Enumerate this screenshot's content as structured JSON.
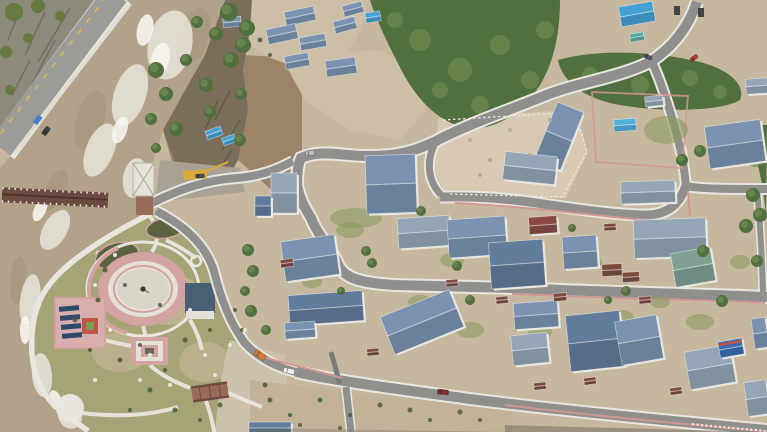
{
  "meta": {
    "description": "Aerial drone photograph: a Tibetan-style riverside village of blue-roofed houses with winding fenced roads, a covered wooden bridge over a rushing silt-laden river, a cliffside highway, construction lots, forested hillside, and a riverside park with an oval pink plaza",
    "width": 767,
    "height": 432
  },
  "palette": {
    "ground": "#c6b89e",
    "hillside": "#9d8468",
    "dirtTop": "#cdbfa6",
    "lot": "#d8cab2",
    "scree": "#a9a294",
    "bottomDirt": "#c2b298",
    "pebble": "#ccc2ab",
    "park": "#a6a476",
    "parkTan": "#c3b795",
    "cliff": "#8d897b",
    "cliffDark": "#5f5c50",
    "moss": "#66793f",
    "river": "#b3a28a",
    "riverDark": "#a3927a",
    "foam": "#e9e5dc",
    "foamBright": "#f7f5ef",
    "bank": "#7a6d5a",
    "bankDark": "#55503f",
    "highway": "#9b9b97",
    "lane": "#d9b94e",
    "wall": "#e0ddd3",
    "road": "#8f908e",
    "roadDark": "#7a7a78",
    "roadEdge": "#e9e7df",
    "pink": "#d29693",
    "plazaRing": "#d2a3a1",
    "plazaMid": "#e4e1d9",
    "plazaIn": "#d9d5ca",
    "pathWhite": "#e9e6df",
    "pond": "#5a6240",
    "statue": "#3b3b34",
    "roofBlue": "#7b93b0",
    "roofSlate": "#627c9b",
    "roofGray": "#95a7b6",
    "roofTeal": "#7fa093",
    "roofMaroon": "#8a4a42",
    "roofBrown": "#7d4b3c",
    "roofBanner": "#3a6db0",
    "wallWhite": "#e8e6de",
    "tarpBlue": "#45a0d4",
    "tarpTeal": "#56a8a4",
    "poolBlue": "#4fb0dc",
    "bridge": "#6b4a40",
    "towerRoof": "#e6e3da",
    "towerBase": "#9a6a58",
    "pavilion": "#4a5e74",
    "panel": "#2e4a68",
    "solarPad": "#d8aeae",
    "redSquare": "#c05548",
    "garden": "#7e9a55",
    "grassYard": "#8a9a5f",
    "forest": "#51703f",
    "forestLight": "#6d8a50",
    "bush": "#4c5c36",
    "crane": "#d9a93a",
    "shadow": "#6b675e",
    "sign": "#3f7fd0"
  },
  "scene": {
    "houses": [
      {
        "x": 391,
        "y": 184,
        "w": 50,
        "h": 58,
        "r": -2,
        "c": "roofBlue"
      },
      {
        "x": 284,
        "y": 193,
        "w": 26,
        "h": 40,
        "r": 0,
        "c": "roofGray"
      },
      {
        "x": 263,
        "y": 206,
        "w": 16,
        "h": 20,
        "r": 0,
        "c": "roofSlate"
      },
      {
        "x": 310,
        "y": 258,
        "w": 54,
        "h": 40,
        "r": -8,
        "c": "roofBlue"
      },
      {
        "x": 326,
        "y": 308,
        "w": 74,
        "h": 30,
        "r": -4,
        "c": "roofSlate"
      },
      {
        "x": 300,
        "y": 330,
        "w": 30,
        "h": 16,
        "r": -4,
        "c": "roofBlue"
      },
      {
        "x": 422,
        "y": 322,
        "w": 74,
        "h": 40,
        "r": -22,
        "c": "roofBlue"
      },
      {
        "x": 424,
        "y": 232,
        "w": 52,
        "h": 30,
        "r": -4,
        "c": "roofGray"
      },
      {
        "x": 477,
        "y": 237,
        "w": 58,
        "h": 38,
        "r": -4,
        "c": "roofBlue"
      },
      {
        "x": 517,
        "y": 264,
        "w": 54,
        "h": 46,
        "r": -4,
        "c": "roofSlate"
      },
      {
        "x": 543,
        "y": 225,
        "w": 28,
        "h": 17,
        "r": -4,
        "c": "roofMaroon"
      },
      {
        "x": 559,
        "y": 136,
        "w": 28,
        "h": 62,
        "r": 22,
        "c": "roofBlue"
      },
      {
        "x": 530,
        "y": 168,
        "w": 52,
        "h": 28,
        "r": 6,
        "c": "roofGray"
      },
      {
        "x": 735,
        "y": 144,
        "w": 56,
        "h": 42,
        "r": -8,
        "c": "roofBlue"
      },
      {
        "x": 757,
        "y": 86,
        "w": 22,
        "h": 15,
        "r": -4,
        "c": "roofGray"
      },
      {
        "x": 648,
        "y": 192,
        "w": 54,
        "h": 22,
        "r": -2,
        "c": "roofGray"
      },
      {
        "x": 670,
        "y": 238,
        "w": 72,
        "h": 38,
        "r": -2,
        "c": "roofGray"
      },
      {
        "x": 580,
        "y": 252,
        "w": 34,
        "h": 32,
        "r": -4,
        "c": "roofBlue"
      },
      {
        "x": 693,
        "y": 267,
        "w": 40,
        "h": 34,
        "r": -10,
        "c": "roofTeal"
      },
      {
        "x": 536,
        "y": 315,
        "w": 44,
        "h": 26,
        "r": -4,
        "c": "roofBlue"
      },
      {
        "x": 595,
        "y": 341,
        "w": 54,
        "h": 56,
        "r": -6,
        "c": "roofSlate"
      },
      {
        "x": 639,
        "y": 340,
        "w": 42,
        "h": 44,
        "r": -10,
        "c": "roofBlue"
      },
      {
        "x": 710,
        "y": 367,
        "w": 46,
        "h": 38,
        "r": -10,
        "c": "roofGray"
      },
      {
        "x": 731,
        "y": 348,
        "w": 24,
        "h": 16,
        "r": -10,
        "c": "roofBanner"
      },
      {
        "x": 760,
        "y": 333,
        "w": 14,
        "h": 30,
        "r": -8,
        "c": "roofBlue"
      },
      {
        "x": 530,
        "y": 349,
        "w": 36,
        "h": 30,
        "r": -6,
        "c": "roofGray"
      },
      {
        "x": 270,
        "y": 428,
        "w": 42,
        "h": 12,
        "r": 0,
        "c": "roofSlate"
      },
      {
        "x": 654,
        "y": 101,
        "w": 18,
        "h": 10,
        "r": -6,
        "c": "roofGray"
      },
      {
        "x": 757,
        "y": 398,
        "w": 22,
        "h": 34,
        "r": -8,
        "c": "roofGray"
      }
    ],
    "sheds": [
      {
        "x": 300,
        "y": 16,
        "w": 30,
        "h": 14,
        "r": -12,
        "c": "roofBlue"
      },
      {
        "x": 282,
        "y": 34,
        "w": 30,
        "h": 15,
        "r": -12,
        "c": "roofBlue"
      },
      {
        "x": 313,
        "y": 42,
        "w": 26,
        "h": 13,
        "r": -10,
        "c": "roofBlue"
      },
      {
        "x": 345,
        "y": 25,
        "w": 22,
        "h": 12,
        "r": -15,
        "c": "roofBlue"
      },
      {
        "x": 353,
        "y": 9,
        "w": 20,
        "h": 11,
        "r": -15,
        "c": "roofBlue"
      },
      {
        "x": 373,
        "y": 17,
        "w": 15,
        "h": 10,
        "r": -10,
        "c": "tarpBlue"
      },
      {
        "x": 341,
        "y": 67,
        "w": 30,
        "h": 16,
        "r": -8,
        "c": "roofBlue"
      },
      {
        "x": 297,
        "y": 61,
        "w": 24,
        "h": 13,
        "r": -10,
        "c": "roofBlue"
      },
      {
        "x": 232,
        "y": 22,
        "w": 18,
        "h": 10,
        "r": -5,
        "c": "roofBlue"
      },
      {
        "x": 637,
        "y": 14,
        "w": 34,
        "h": 20,
        "r": -10,
        "c": "tarpBlue"
      },
      {
        "x": 637,
        "y": 37,
        "w": 14,
        "h": 8,
        "r": -10,
        "c": "tarpTeal"
      },
      {
        "x": 214,
        "y": 133,
        "w": 16,
        "h": 9,
        "r": -20,
        "c": "tarpBlue"
      },
      {
        "x": 229,
        "y": 140,
        "w": 13,
        "h": 8,
        "r": -20,
        "c": "tarpBlue"
      },
      {
        "x": 625,
        "y": 125,
        "w": 22,
        "h": 12,
        "r": -4,
        "c": "poolBlue"
      },
      {
        "x": 612,
        "y": 270,
        "w": 20,
        "h": 12,
        "r": -3,
        "c": "roofBrown"
      },
      {
        "x": 631,
        "y": 277,
        "w": 17,
        "h": 10,
        "r": -3,
        "c": "roofBrown"
      },
      {
        "x": 287,
        "y": 263,
        "w": 13,
        "h": 8,
        "r": -8,
        "c": "roofBrown"
      },
      {
        "x": 373,
        "y": 352,
        "w": 12,
        "h": 7,
        "r": -5,
        "c": "roofBrown"
      },
      {
        "x": 452,
        "y": 283,
        "w": 12,
        "h": 7,
        "r": -5,
        "c": "roofBrown"
      },
      {
        "x": 502,
        "y": 300,
        "w": 12,
        "h": 7,
        "r": -5,
        "c": "roofBrown"
      },
      {
        "x": 560,
        "y": 297,
        "w": 13,
        "h": 8,
        "r": -5,
        "c": "roofBrown"
      },
      {
        "x": 645,
        "y": 300,
        "w": 12,
        "h": 7,
        "r": -5,
        "c": "roofBrown"
      },
      {
        "x": 590,
        "y": 381,
        "w": 12,
        "h": 7,
        "r": -8,
        "c": "roofBrown"
      },
      {
        "x": 676,
        "y": 391,
        "w": 12,
        "h": 7,
        "r": -8,
        "c": "roofBrown"
      },
      {
        "x": 540,
        "y": 386,
        "w": 12,
        "h": 7,
        "r": -6,
        "c": "roofBrown"
      },
      {
        "x": 610,
        "y": 227,
        "w": 12,
        "h": 7,
        "r": -3,
        "c": "roofBrown"
      }
    ],
    "trees": [
      [
        156,
        70,
        8
      ],
      [
        166,
        94,
        7
      ],
      [
        151,
        119,
        6
      ],
      [
        176,
        129,
        7
      ],
      [
        186,
        60,
        6
      ],
      [
        206,
        85,
        7
      ],
      [
        231,
        60,
        8
      ],
      [
        241,
        94,
        6
      ],
      [
        216,
        34,
        7
      ],
      [
        247,
        28,
        8
      ],
      [
        197,
        22,
        6
      ],
      [
        210,
        112,
        6
      ],
      [
        240,
        140,
        6
      ],
      [
        156,
        148,
        5
      ],
      [
        229,
        12,
        9
      ],
      [
        243,
        45,
        8
      ],
      [
        248,
        250,
        6
      ],
      [
        253,
        271,
        6
      ],
      [
        245,
        291,
        5
      ],
      [
        251,
        311,
        6
      ],
      [
        266,
        330,
        5
      ],
      [
        366,
        251,
        5
      ],
      [
        372,
        263,
        5
      ],
      [
        457,
        266,
        5
      ],
      [
        470,
        300,
        5
      ],
      [
        626,
        291,
        5
      ],
      [
        703,
        251,
        6
      ],
      [
        722,
        301,
        6
      ],
      [
        746,
        226,
        7
      ],
      [
        757,
        261,
        6
      ],
      [
        682,
        160,
        6
      ],
      [
        700,
        151,
        6
      ],
      [
        421,
        211,
        5
      ],
      [
        341,
        291,
        4
      ],
      [
        608,
        300,
        4
      ],
      [
        572,
        228,
        4
      ],
      [
        753,
        195,
        7
      ],
      [
        760,
        215,
        7
      ]
    ],
    "bushes": [
      [
        105,
        270,
        2.5
      ],
      [
        125,
        285,
        2
      ],
      [
        98,
        300,
        2.5
      ],
      [
        140,
        345,
        2
      ],
      [
        120,
        360,
        2.5
      ],
      [
        165,
        370,
        2
      ],
      [
        185,
        340,
        2.5
      ],
      [
        210,
        330,
        2
      ],
      [
        150,
        390,
        2.5
      ],
      [
        130,
        410,
        2
      ],
      [
        175,
        410,
        2.5
      ],
      [
        200,
        420,
        2
      ],
      [
        220,
        405,
        2.5
      ],
      [
        90,
        350,
        2
      ],
      [
        75,
        320,
        2.5
      ],
      [
        160,
        305,
        2
      ],
      [
        270,
        400,
        2.5
      ],
      [
        290,
        415,
        2
      ],
      [
        320,
        400,
        2.5
      ],
      [
        350,
        415,
        2
      ],
      [
        380,
        405,
        2.5
      ],
      [
        300,
        425,
        2
      ],
      [
        410,
        410,
        2.5
      ],
      [
        430,
        420,
        2
      ],
      [
        460,
        412,
        2.5
      ],
      [
        340,
        428,
        2
      ],
      [
        265,
        385,
        2.5
      ],
      [
        480,
        420,
        2
      ],
      [
        260,
        40,
        2.5
      ],
      [
        270,
        55,
        2
      ],
      [
        235,
        310,
        2
      ],
      [
        242,
        330,
        2
      ]
    ],
    "rocks": [
      {
        "x": 95,
        "y": 285,
        "r": 2,
        "c": "#e8e5da"
      },
      {
        "x": 110,
        "y": 330,
        "r": 2,
        "c": "#e8e5da"
      },
      {
        "x": 150,
        "y": 355,
        "r": 2,
        "c": "#e8e5da"
      },
      {
        "x": 190,
        "y": 310,
        "r": 2,
        "c": "#e8e5da"
      },
      {
        "x": 205,
        "y": 355,
        "r": 2,
        "c": "#e8e5da"
      },
      {
        "x": 230,
        "y": 345,
        "r": 2,
        "c": "#e8e5da"
      },
      {
        "x": 140,
        "y": 380,
        "r": 2,
        "c": "#e8e5da"
      },
      {
        "x": 170,
        "y": 385,
        "r": 2,
        "c": "#e8e5da"
      },
      {
        "x": 95,
        "y": 380,
        "r": 2,
        "c": "#e8e5da"
      },
      {
        "x": 215,
        "y": 375,
        "r": 2,
        "c": "#e8e5da"
      },
      {
        "x": 245,
        "y": 330,
        "r": 2,
        "c": "#e8e5da"
      },
      {
        "x": 115,
        "y": 255,
        "r": 2,
        "c": "#e8e5da"
      },
      {
        "x": 470,
        "y": 140,
        "r": 2,
        "c": "#b3ab9b"
      },
      {
        "x": 490,
        "y": 160,
        "r": 2,
        "c": "#b3ab9b"
      },
      {
        "x": 510,
        "y": 130,
        "r": 2,
        "c": "#b3ab9b"
      },
      {
        "x": 530,
        "y": 155,
        "r": 2,
        "c": "#b3ab9b"
      },
      {
        "x": 480,
        "y": 175,
        "r": 2,
        "c": "#b3ab9b"
      },
      {
        "x": 550,
        "y": 120,
        "r": 2,
        "c": "#b3ab9b"
      }
    ],
    "yards": [
      [
        350,
        230,
        14,
        8
      ],
      [
        452,
        260,
        12,
        7
      ],
      [
        470,
        330,
        14,
        8
      ],
      [
        540,
        332,
        12,
        7
      ],
      [
        622,
        318,
        12,
        8
      ],
      [
        700,
        322,
        14,
        8
      ],
      [
        592,
        262,
        10,
        6
      ],
      [
        660,
        302,
        10,
        6
      ],
      [
        740,
        262,
        10,
        7
      ],
      [
        420,
        302,
        12,
        7
      ],
      [
        312,
        282,
        10,
        6
      ],
      [
        356,
        218,
        26,
        10
      ],
      [
        666,
        130,
        22,
        14
      ]
    ],
    "cars": [
      {
        "x": 289,
        "y": 371,
        "w": 11,
        "h": 5,
        "r": 12,
        "c": "#f2f1ec"
      },
      {
        "x": 443,
        "y": 392,
        "w": 11,
        "h": 5,
        "r": 6,
        "c": "#7a2e30"
      },
      {
        "x": 310,
        "y": 153,
        "w": 9,
        "h": 5,
        "r": -4,
        "c": "#b9bcc0"
      },
      {
        "x": 694,
        "y": 58,
        "w": 8,
        "h": 4,
        "r": -35,
        "c": "#b33a32"
      },
      {
        "x": 648,
        "y": 57,
        "w": 8,
        "h": 4,
        "r": 20,
        "c": "#55565a"
      },
      {
        "x": 260,
        "y": 355,
        "w": 12,
        "h": 6,
        "r": 35,
        "c": "#cf7a36"
      },
      {
        "x": 200,
        "y": 176,
        "w": 9,
        "h": 4,
        "r": -3,
        "c": "#4a4e55"
      },
      {
        "x": 46,
        "y": 131,
        "w": 9,
        "h": 5,
        "r": -53,
        "c": "#3a3e42"
      }
    ]
  }
}
